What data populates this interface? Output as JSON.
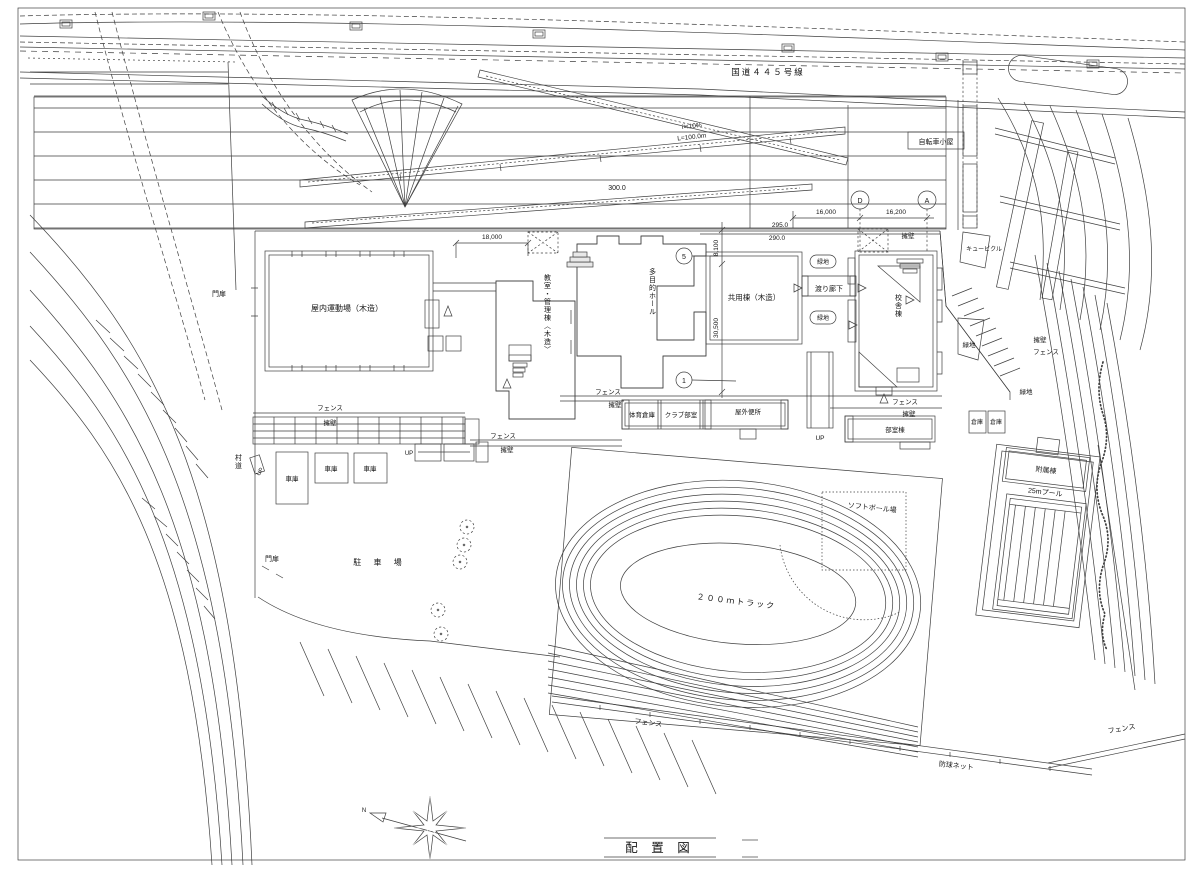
{
  "drawing": {
    "title": "配 置 図",
    "labels": {
      "route445": "国道４４５号線",
      "ramp_grade": "i≒10%",
      "ramp_length": "L=100.0m",
      "bike_shed": "自転車小屋",
      "grid_d": "D",
      "grid_a": "A",
      "grid_1": "1",
      "grid_5": "5",
      "wall": "擁壁",
      "fence": "フェンス",
      "green": "緑地",
      "gate": "門扉",
      "gym": "屋内運動場（木造）",
      "classroom": "教室・管理棟〈木造〉",
      "hall": "多目的ホール",
      "common": "共用棟（木造）",
      "corridor": "渡り廊下",
      "school": "校舎棟",
      "cubicle": "キュービクル",
      "gym_storage": "体育倉庫",
      "club_room": "クラブ部室",
      "toilet": "屋外便所",
      "up": "UP",
      "clubhouse": "部室棟",
      "storage": "倉庫",
      "garage": "車庫",
      "village_road": "村道",
      "parking": "駐 車 場",
      "softball": "ソフトボール場",
      "track": "２００ｍトラック",
      "net": "防球ネット",
      "annex": "附属棟",
      "pool": "25mプール",
      "north": "N"
    },
    "dimensions": {
      "d300": "300.0",
      "d295": "295.0",
      "d290": "290.0",
      "d16000": "16,000",
      "d16200": "16,200",
      "d18000": "18,000",
      "d8100": "8,100",
      "d30500": "30,500"
    },
    "colors": {
      "line": "#3f3f3f",
      "wall_gray": "#bdbdbd",
      "paper": "#ffffff"
    }
  }
}
